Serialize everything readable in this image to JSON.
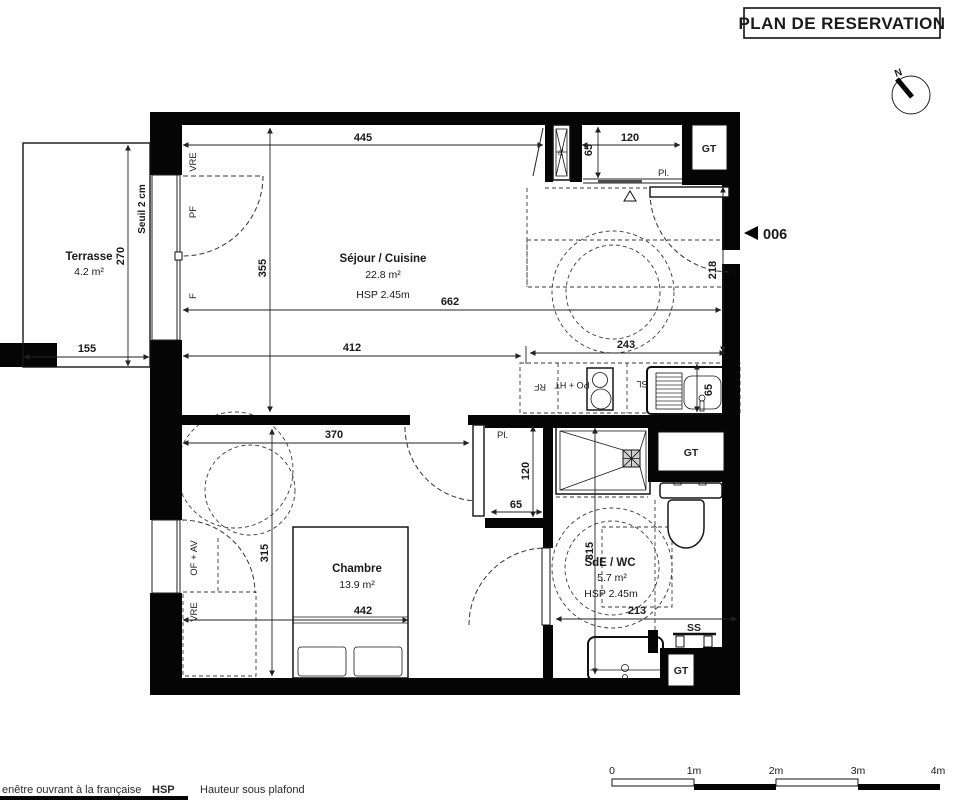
{
  "title": "PLAN DE RESERVATION",
  "unit": {
    "number": "006"
  },
  "compass": {
    "north": "N"
  },
  "rooms": {
    "terrasse": {
      "name": "Terrasse",
      "area": "4.2 m²"
    },
    "sejour": {
      "name": "Séjour / Cuisine",
      "area": "22.8 m²",
      "ceiling": "HSP 2.45m"
    },
    "chambre": {
      "name": "Chambre",
      "area": "13.9 m²"
    },
    "sde": {
      "name": "SdE / WC",
      "area": "5.7 m²",
      "ceiling": "HSP 2.45m"
    }
  },
  "labels": {
    "seuil": "Seuil 2 cm",
    "vre_terrace": "VRE",
    "pf": "PF",
    "f": "F",
    "of_av": "OF + AV",
    "vre_chambre": "VRE",
    "pl_entry": "Pl.",
    "pl_closet": "Pl.",
    "gt_top": "GT",
    "gt_mid": "GT",
    "gt_bottom": "GT",
    "ss": "SS",
    "rf": "RF",
    "po_ht": "PO + HT",
    "sl": "SL",
    "shaft": "PL"
  },
  "dimensions": {
    "top_left": "445",
    "top_niche": "120",
    "niche_depth": "65",
    "terrasse_height": "270",
    "terrasse_width": "155",
    "sejour_height": "355",
    "sejour_width": "662",
    "sejour_left": "412",
    "sejour_right": "243",
    "entry_height": "218",
    "chambre_top": "370",
    "chambre_height": "315",
    "chambre_bed": "442",
    "closet_height": "120",
    "closet_width": "65",
    "sink": "65",
    "sde_height": "315",
    "sde_width": "213"
  },
  "scalebar": {
    "labels": [
      "0",
      "1m",
      "2m",
      "3m",
      "4m"
    ]
  },
  "legend": {
    "window": "enêtre ouvrant à la française",
    "hsp": "HSP",
    "hsp_meaning": "Hauteur sous plafond"
  }
}
